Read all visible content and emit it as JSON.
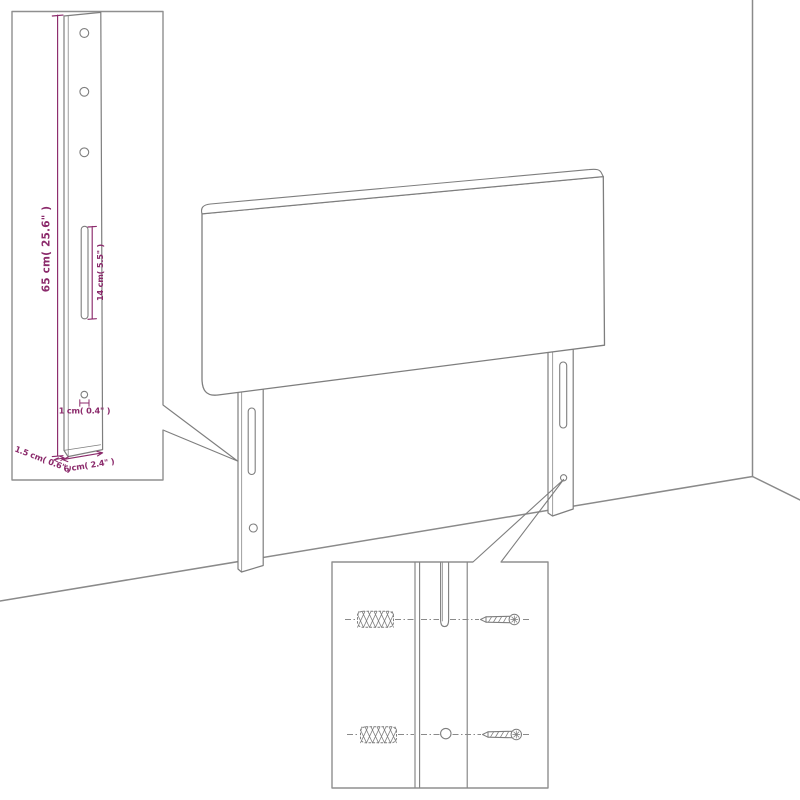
{
  "diagram": {
    "type": "headboard-mounting-dimension-diagram",
    "labels": {
      "height": "65 cm( 25.6\" )",
      "slot_length": "14 cm( 5.5\" )",
      "hole_diameter": "1 cm( 0.4\" )",
      "thickness": "1.5 cm( 0.6\" )",
      "width": "6 cm( 2.4\" )"
    },
    "colors": {
      "dimension": "#8B2A6B",
      "line": "#7E7E7E",
      "wall_line": "#8A8A8A",
      "inset_border": "#8F8F8F",
      "background": "#FFFFFF"
    }
  }
}
